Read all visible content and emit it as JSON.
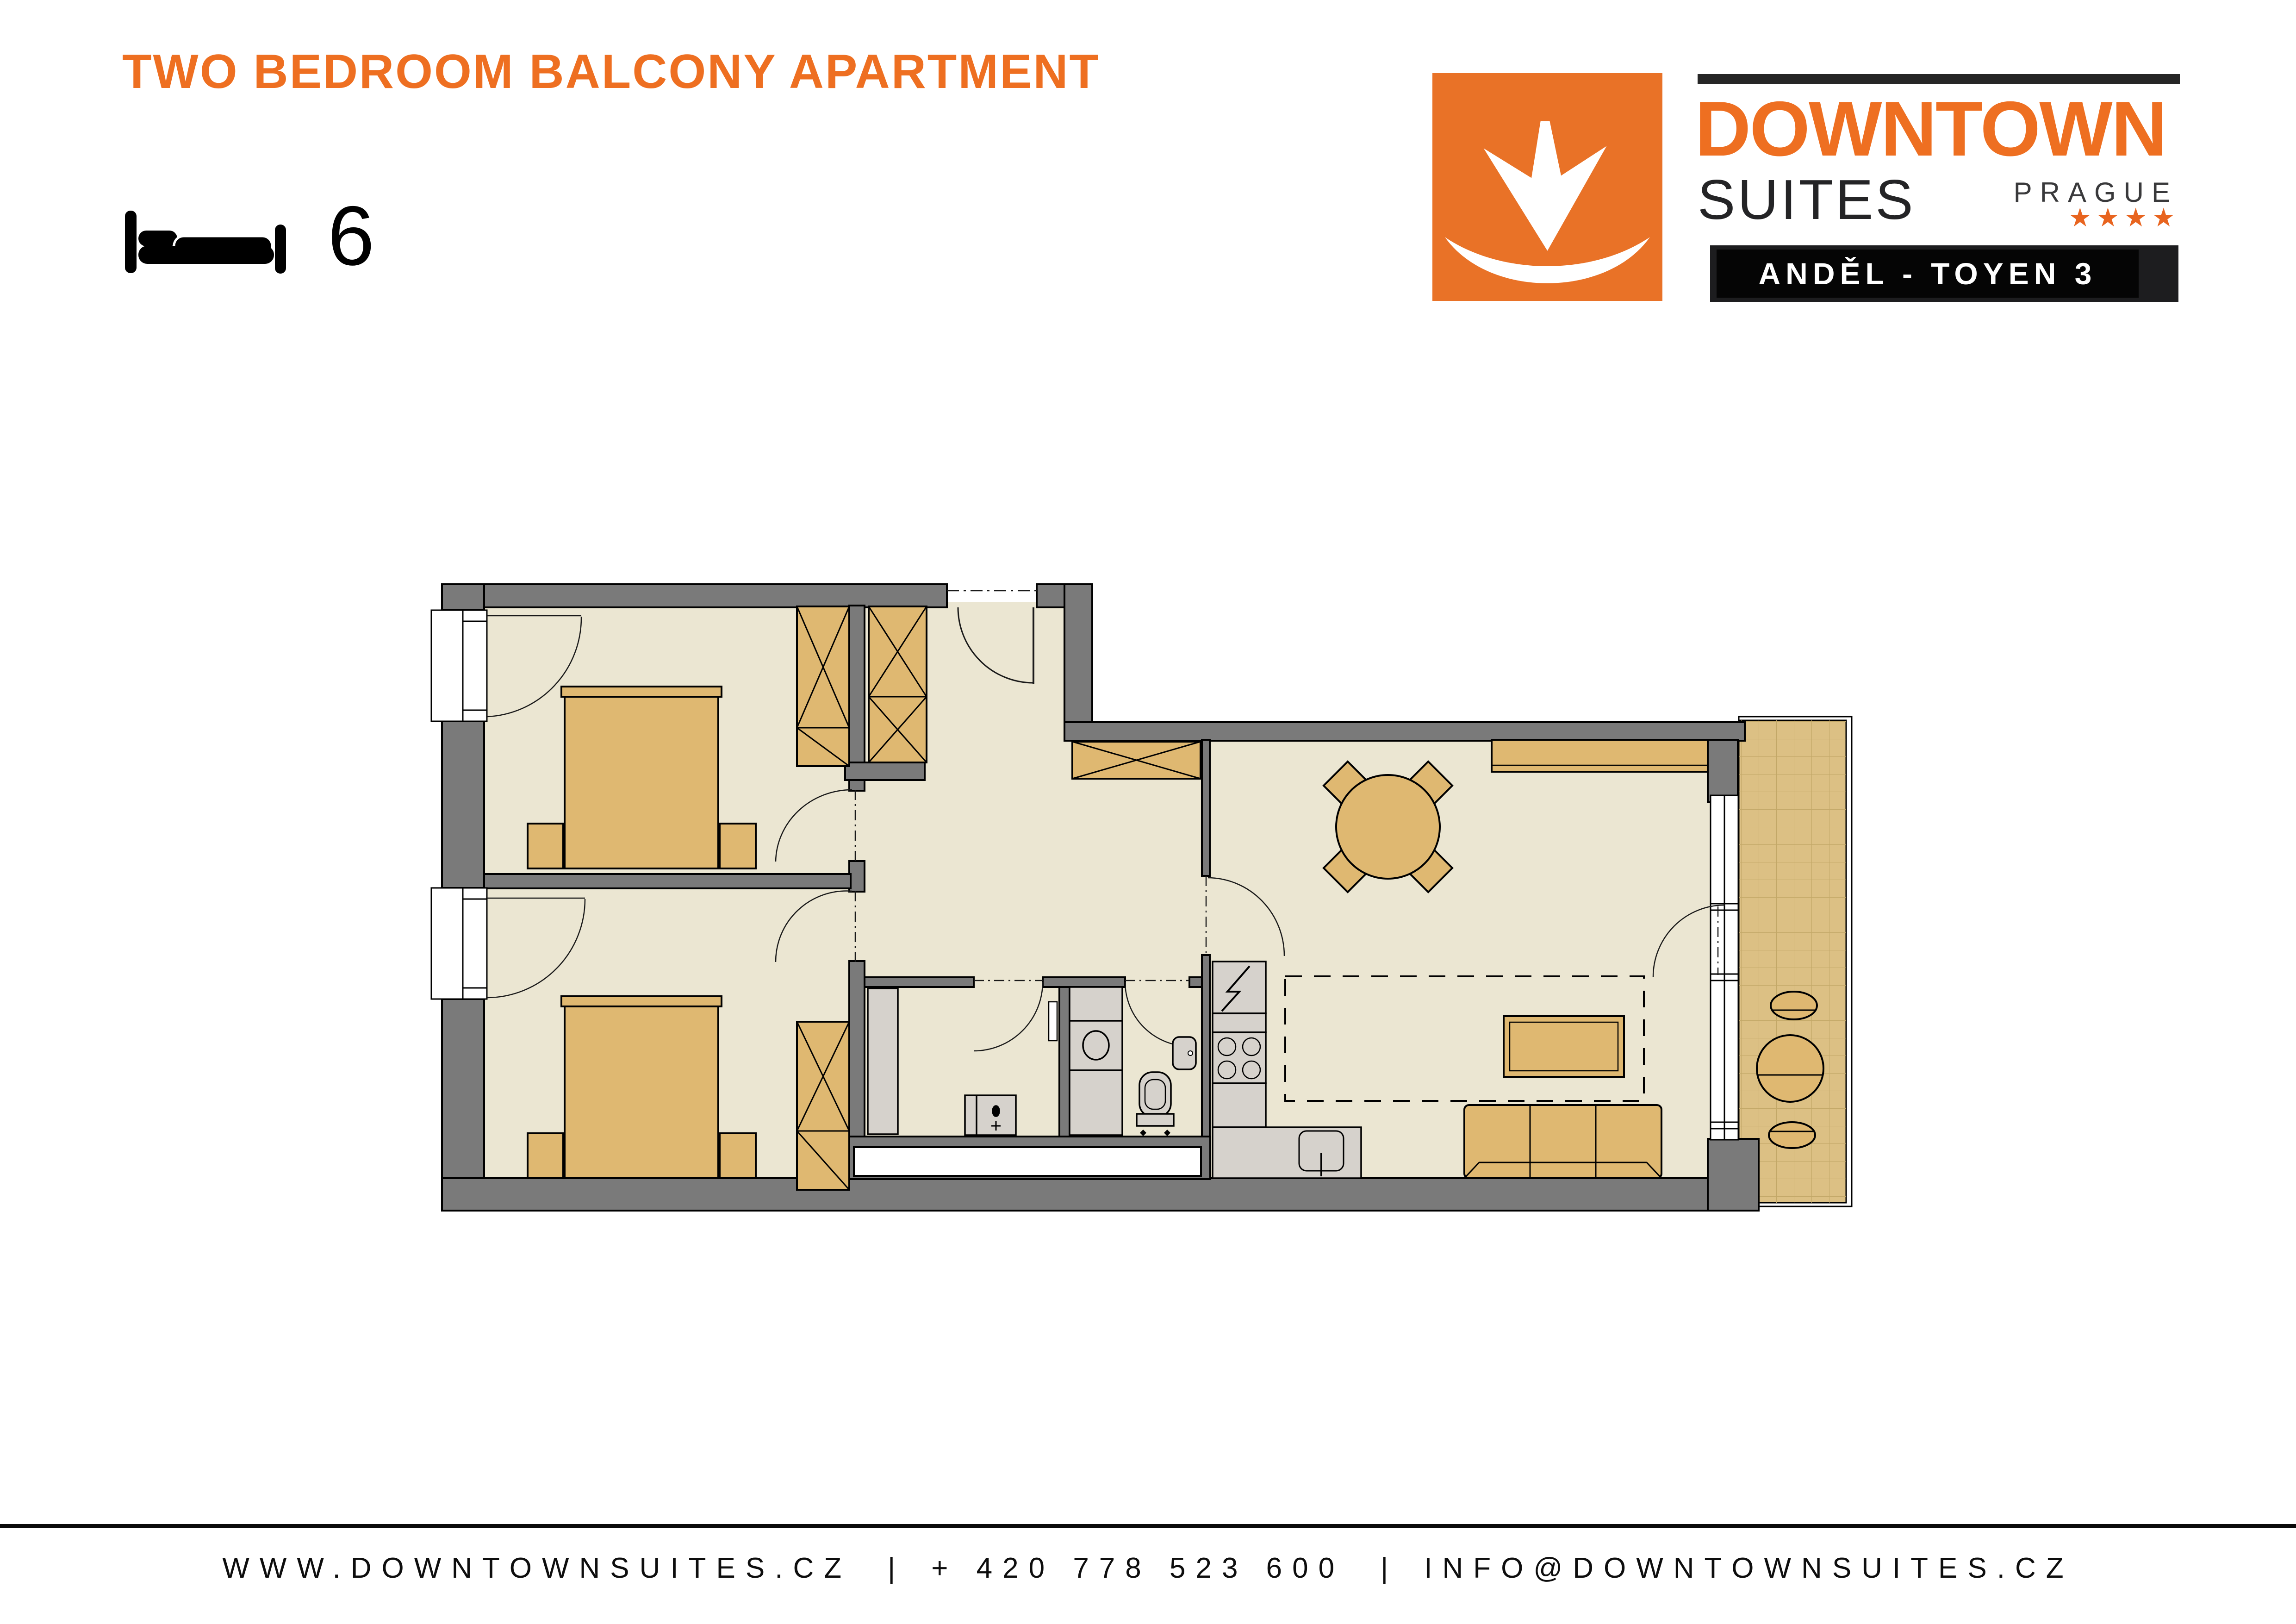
{
  "header": {
    "title": "TWO BEDROOM BALCONY APARTMENT",
    "title_color": "#EE6F21",
    "capacity_beds": "6",
    "capacity_icon": "bed-icon"
  },
  "logo": {
    "brand": "DOWNTOWN",
    "brand_sub": "SUITES",
    "city": "PRAGUE",
    "stars": "★★★★",
    "location_badge": "ANDĚL - TOYEN 3",
    "mark_icon": "downtown-arrow-swoosh-icon",
    "colors": {
      "orange": "#E97227",
      "text_orange": "#EE6F21",
      "dark": "#1d1d1f",
      "star_orange": "#E8641F"
    }
  },
  "footer": {
    "website": "WWW.DOWNTOWNSUITES.CZ",
    "separator": "|",
    "phone": "+ 420 778 523 600",
    "email": "INFO@DOWNTOWNSUITES.CZ"
  },
  "floorplan": {
    "type": "apartment-floor-plan",
    "colors": {
      "wall": "#7a7a7a",
      "floor": "#EBE6D2",
      "furniture_wood": "#DFB871",
      "appliance_gray": "#D6D2CC",
      "balcony_tile": "#DCC084",
      "outline": "#000000"
    },
    "rooms": [
      {
        "name": "bedroom-1",
        "position": "top-left",
        "items": [
          "window with swing",
          "entry door",
          "double bed",
          "nightstand-left",
          "nightstand-right",
          "wardrobe"
        ]
      },
      {
        "name": "bedroom-2",
        "position": "bottom-left",
        "items": [
          "window with swing",
          "entry door",
          "double bed",
          "nightstand-left",
          "nightstand-right",
          "wardrobe"
        ]
      },
      {
        "name": "hall",
        "position": "center",
        "items": [
          "entrance door",
          "wardrobe-left",
          "wardrobe-top"
        ]
      },
      {
        "name": "bathroom",
        "position": "bottom-center",
        "items": [
          "door",
          "closet strip",
          "washing machine",
          "mirror"
        ]
      },
      {
        "name": "wc",
        "position": "bottom-center-right",
        "items": [
          "door",
          "washer column",
          "toilet",
          "hand basin"
        ]
      },
      {
        "name": "kitchen",
        "position": "bottom-right-of-center",
        "items": [
          "electric panel",
          "counter",
          "stove 4 burners",
          "kitchen sink"
        ]
      },
      {
        "name": "living-dining-room",
        "position": "right",
        "items": [
          "sideboard",
          "dining table round",
          "4 dining chairs",
          "rug (dashed)",
          "coffee table",
          "sofa 3-seat",
          "balcony french window"
        ]
      },
      {
        "name": "balcony",
        "position": "far-right",
        "items": [
          "tiled floor",
          "round table",
          "chair-top",
          "chair-bottom"
        ]
      }
    ]
  }
}
